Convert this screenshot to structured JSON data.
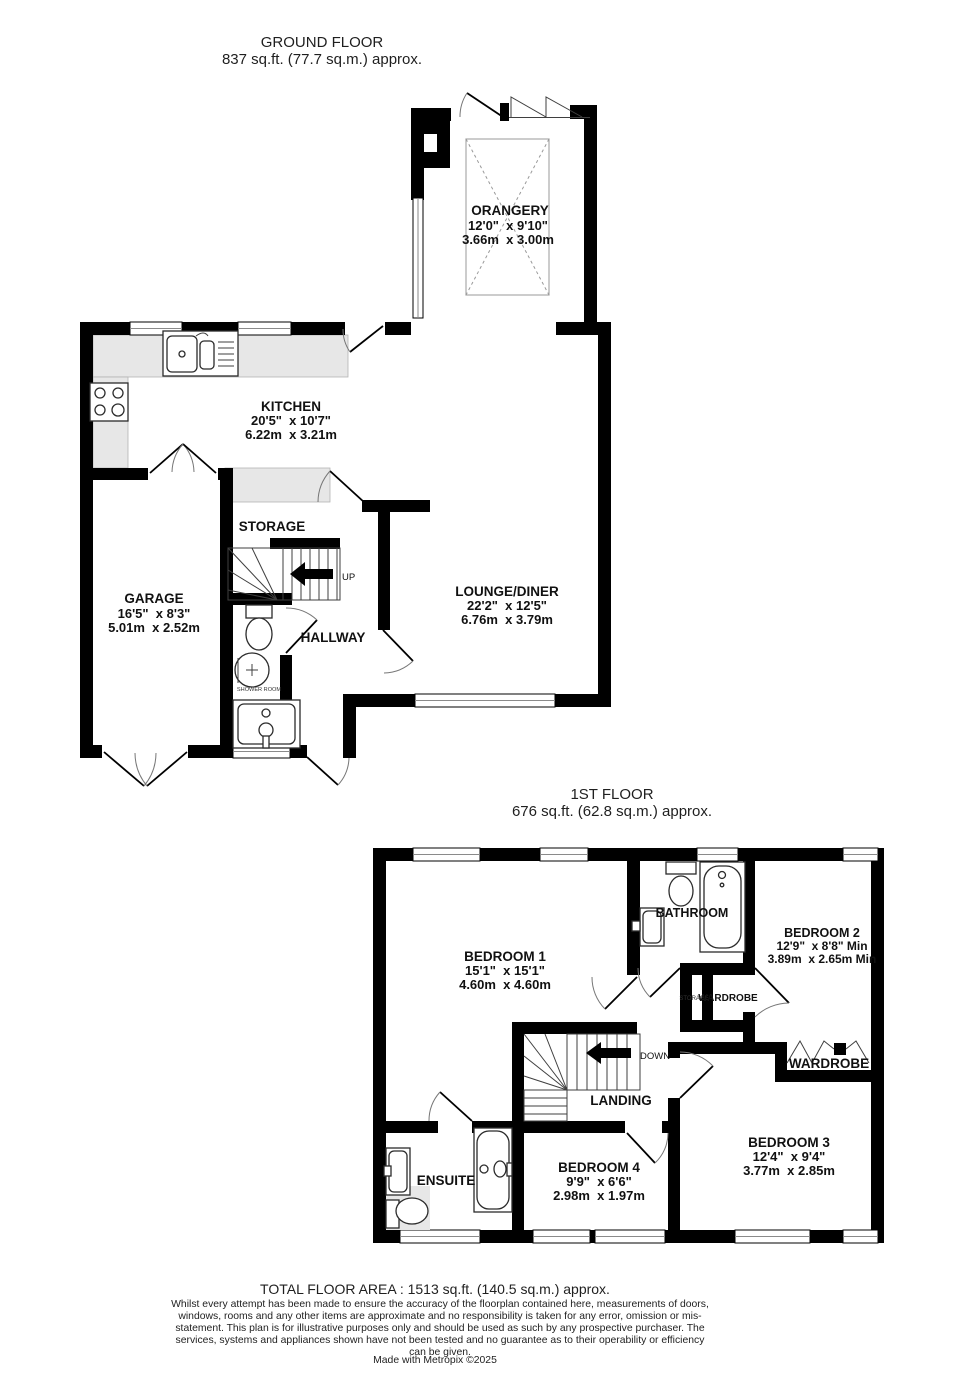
{
  "ground": {
    "title": "GROUND FLOOR",
    "area": "837 sq.ft. (77.7 sq.m.) approx.",
    "orangery": {
      "name": "ORANGERY",
      "imperial": "12'0\"  x 9'10\"",
      "metric": "3.66m  x 3.00m"
    },
    "kitchen": {
      "name": "KITCHEN",
      "imperial": "20'5\"  x 10'7\"",
      "metric": "6.22m  x 3.21m"
    },
    "storage": {
      "name": "STORAGE"
    },
    "garage": {
      "name": "GARAGE",
      "imperial": "16'5\"  x 8'3\"",
      "metric": "5.01m  x 2.52m"
    },
    "hallway": {
      "name": "HALLWAY"
    },
    "shower_room": {
      "name": "SHOWER ROOM"
    },
    "lounge": {
      "name": "LOUNGE/DINER",
      "imperial": "22'2\"  x 12'5\"",
      "metric": "6.76m  x 3.79m"
    },
    "stairs_label": "UP"
  },
  "first": {
    "title": "1ST FLOOR",
    "area": "676 sq.ft. (62.8 sq.m.) approx.",
    "bathroom": {
      "name": "BATHROOM"
    },
    "bedroom1": {
      "name": "BEDROOM 1",
      "imperial": "15'1\"  x 15'1\"",
      "metric": "4.60m  x 4.60m"
    },
    "bedroom2": {
      "name": "BEDROOM 2",
      "imperial": "12'9\"  x 8'8\" Min",
      "metric": "3.89m  x 2.65m Min"
    },
    "storage_closet": {
      "name": "STORAGE"
    },
    "wardrobe_closet": {
      "name": "WARDROBE"
    },
    "wardrobe": {
      "name": "WARDROBE"
    },
    "landing": {
      "name": "LANDING"
    },
    "ensuite": {
      "name": "ENSUITE"
    },
    "bedroom4": {
      "name": "BEDROOM 4",
      "imperial": "9'9\"  x 6'6\"",
      "metric": "2.98m  x 1.97m"
    },
    "bedroom3": {
      "name": "BEDROOM 3",
      "imperial": "12'4\"  x 9'4\"",
      "metric": "3.77m  x 2.85m"
    },
    "stairs_label": "DOWN"
  },
  "footer": {
    "total": "TOTAL FLOOR AREA : 1513 sq.ft. (140.5 sq.m.) approx.",
    "disclaimer": "Whilst every attempt has been made to ensure the accuracy of the floorplan contained here, measurements of doors, windows, rooms and any other items are approximate and no responsibility is taken for any error, omission or mis-statement. This plan is for illustrative purposes only and should be used as such by any prospective purchaser. The services, systems and appliances shown have not been tested and no guarantee as to their operability or efficiency can be given.",
    "credit": "Made with Metropix ©2025"
  },
  "colors": {
    "wall": "#000000",
    "counter": "#e7e7e7",
    "window_line": "#8a8a8a"
  }
}
